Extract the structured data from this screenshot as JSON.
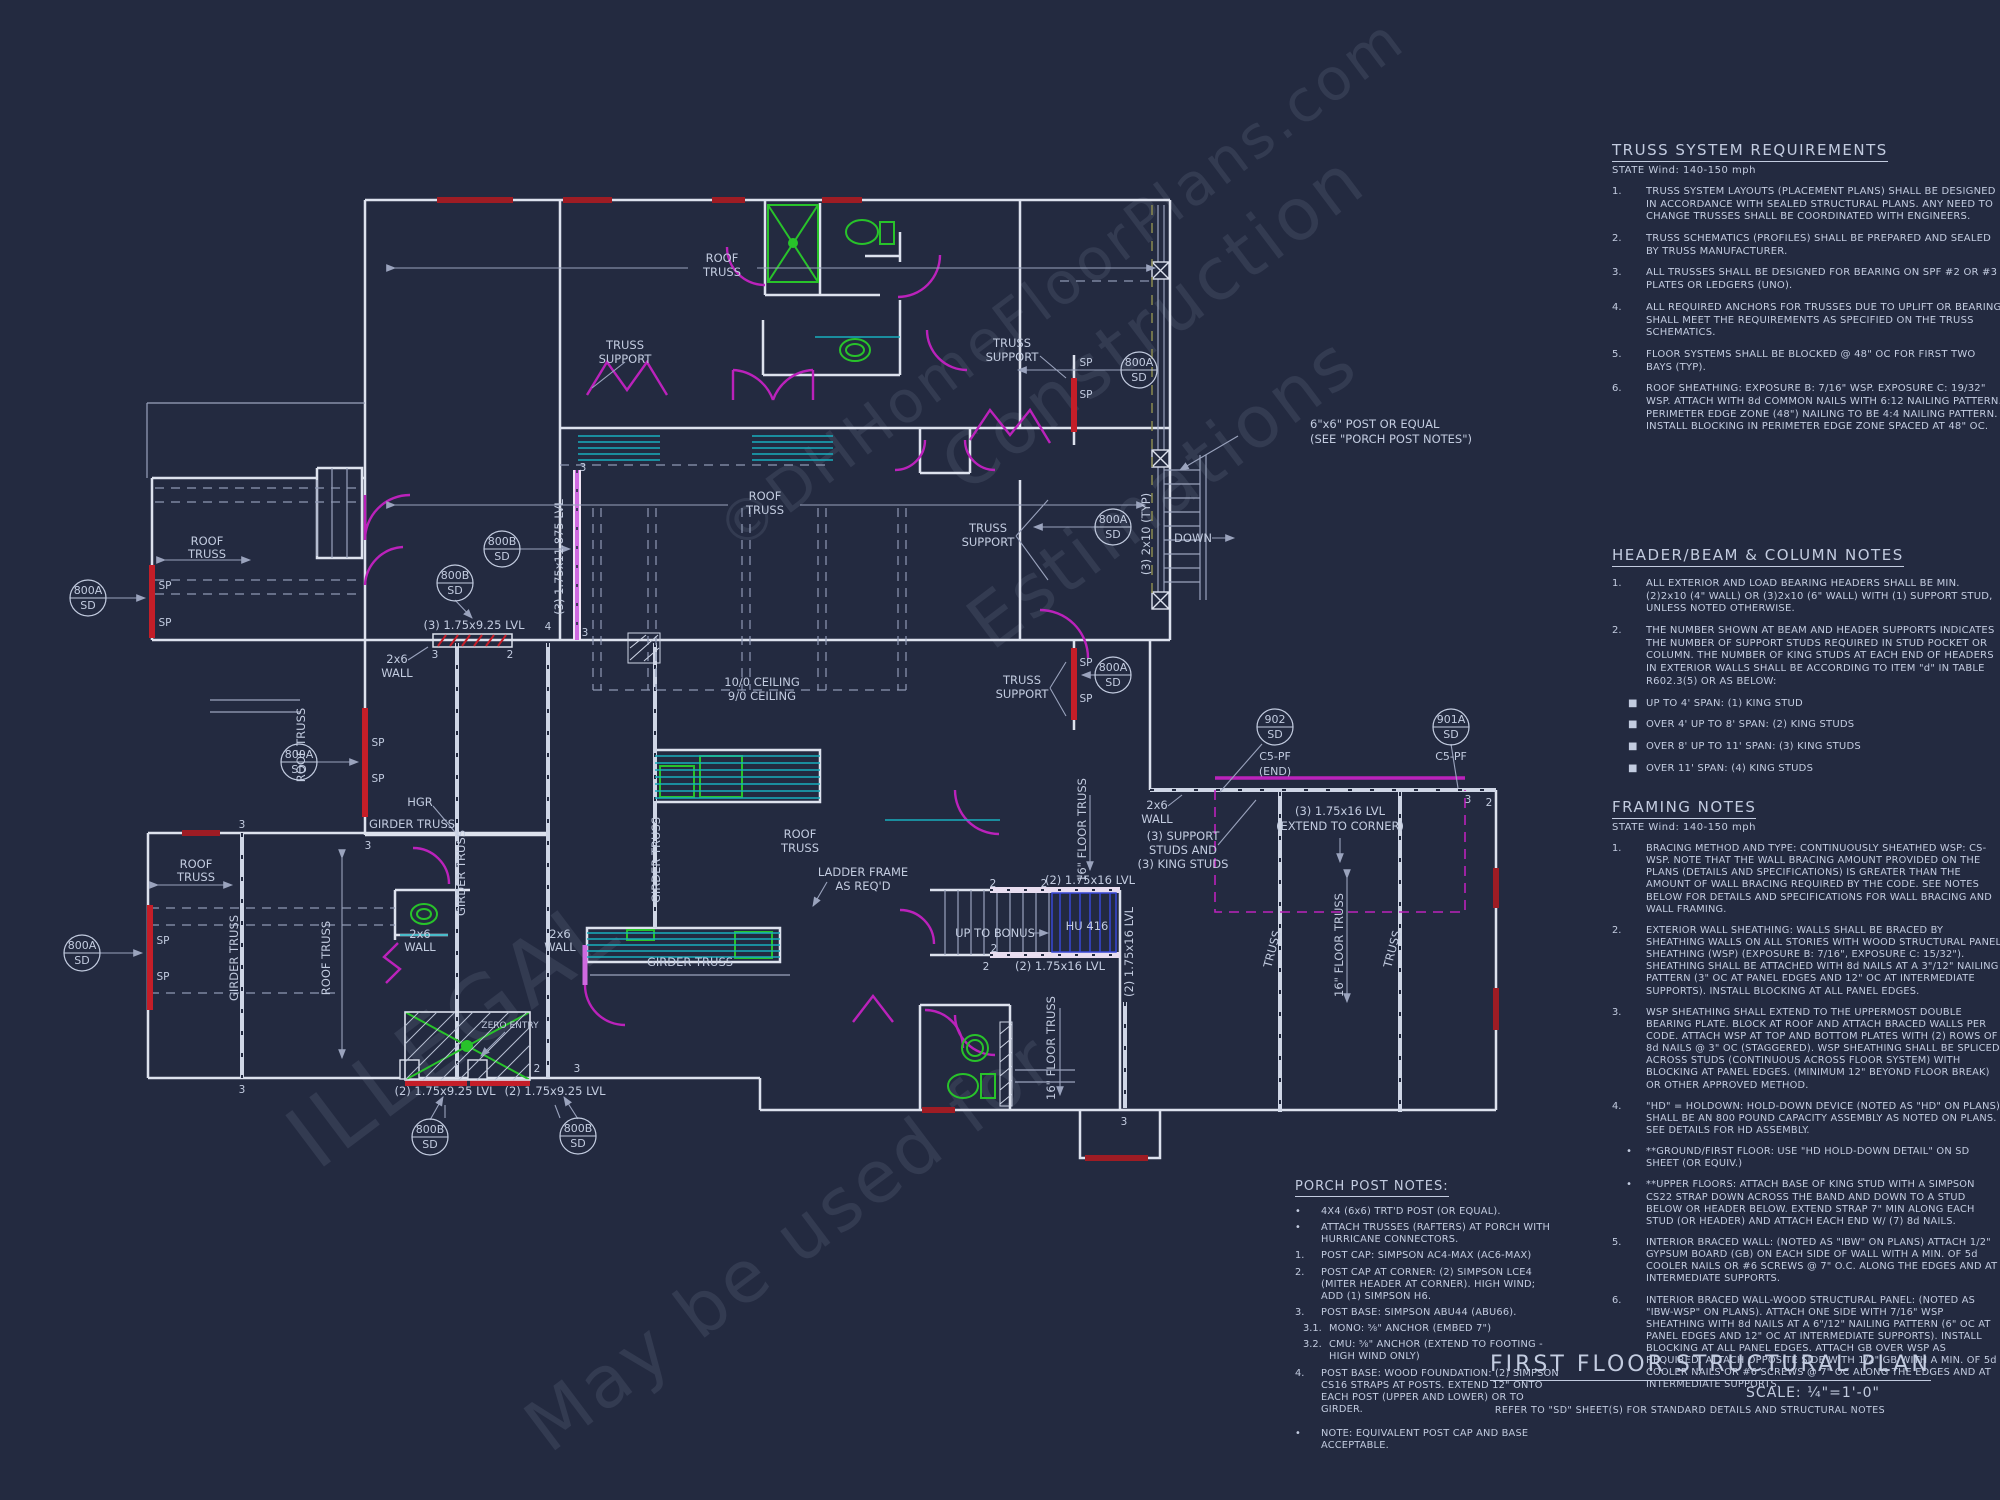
{
  "colors": {
    "background": "#232a40",
    "wall": "#dde2ee",
    "thin": "#9aa3bd",
    "dashed": "#8f99b4",
    "header_red": "#9e1c24",
    "sp_red": "#c41e28",
    "door_magenta": "#bb22bb",
    "beam_violet": "#cf6ae0",
    "fixture_green": "#28c32a",
    "counter_teal": "#18aebe",
    "stair_blue": "#3747d6",
    "text": "#c3cce0"
  },
  "truss_notes": {
    "title": "TRUSS SYSTEM REQUIREMENTS",
    "subtitle": "STATE Wind: 140-150 mph",
    "items": [
      {
        "num": "1.",
        "text": "TRUSS SYSTEM LAYOUTS (PLACEMENT PLANS)  SHALL BE DESIGNED IN ACCORDANCE WITH SEALED STRUCTURAL PLANS. ANY NEED TO CHANGE TRUSSES SHALL BE COORDINATED  WITH  ENGINEERS."
      },
      {
        "num": "2.",
        "text": "TRUSS SCHEMATICS (PROFILES) SHALL BE  PREPARED AND SEALED BY TRUSS  MANUFACTURER."
      },
      {
        "num": "3.",
        "text": "ALL TRUSSES SHALL BE DESIGNED FOR  BEARING ON SPF #2 OR #3 PLATES OR LEDGERS  (UNO)."
      },
      {
        "num": "4.",
        "text": "ALL REQUIRED ANCHORS FOR TRUSSES DUE  TO UPLIFT OR BEARING SHALL MEET THE  REQUIREMENTS AS SPECIFIED ON THE TRUSS  SCHEMATICS."
      },
      {
        "num": "5.",
        "text": "FLOOR SYSTEMS SHALL BE BLOCKED @ 48\" OC FOR FIRST TWO BAYS (TYP)."
      },
      {
        "num": "6.",
        "text": "ROOF SHEATHING: EXPOSURE B: 7/16\" WSP. EXPOSURE C: 19/32\" WSP. ATTACH WITH 8d COMMON NAILS WITH 6:12 NAILING PATTERN. PERIMETER EDGE ZONE (48\") NAILING TO BE 4:4 NAILING PATTERN. INSTALL BLOCKING IN PERIMETER EDGE ZONE SPACED AT 48\" OC."
      }
    ]
  },
  "header_notes": {
    "title": "HEADER/BEAM  &  COLUMN NOTES",
    "items": [
      {
        "num": "1.",
        "text": "ALL EXTERIOR AND LOAD BEARING HEADERS SHALL BE MIN. (2)2x10 (4\" WALL) OR (3)2x10 (6\" WALL) WITH (1) SUPPORT STUD, UNLESS NOTED OTHERWISE."
      },
      {
        "num": "2.",
        "text": "THE NUMBER SHOWN AT BEAM AND HEADER SUPPORTS INDICATES THE NUMBER OF SUPPORT STUDS REQUIRED IN STUD POCKET OR COLUMN. THE NUMBER OF KING STUDS AT EACH END OF HEADERS IN EXTERIOR WALLS SHALL BE ACCORDING TO ITEM \"d\" IN TABLE R602.3(5) OR AS BELOW:"
      }
    ],
    "bullets": [
      {
        "num": "■",
        "text": "UP TO 4' SPAN: (1) KING STUD"
      },
      {
        "num": "■",
        "text": "OVER 4' UP TO 8' SPAN: (2) KING STUDS"
      },
      {
        "num": "■",
        "text": "OVER 8' UP TO 11' SPAN: (3) KING STUDS"
      },
      {
        "num": "■",
        "text": "OVER 11' SPAN: (4) KING STUDS"
      }
    ]
  },
  "framing_notes": {
    "title": "FRAMING NOTES",
    "subtitle": "STATE Wind: 140-150 mph",
    "items": [
      {
        "num": "1.",
        "text": "BRACING METHOD AND TYPE: CONTINUOUSLY SHEATHED WSP: CS-WSP. NOTE THAT THE WALL BRACING AMOUNT PROVIDED ON THE PLANS (DETAILS AND SPECIFICATIONS) IS GREATER THAN THE AMOUNT OF WALL BRACING REQUIRED BY THE CODE. SEE NOTES BELOW FOR DETAILS AND SPECIFICATIONS FOR WALL BRACING AND WALL FRAMING."
      },
      {
        "num": "2.",
        "text": "EXTERIOR WALL SHEATHING: WALLS SHALL BE BRACED BY SHEATHING WALLS ON ALL STORIES WITH WOOD STRUCTURAL PANEL SHEATHING (WSP) (EXPOSURE B: 7/16\", EXPOSURE C: 15/32\"). SHEATHING SHALL BE ATTACHED WITH 8d NAILS AT A 3\"/12\" NAILING PATTERN (3\" OC AT PANEL EDGES AND 12\" OC AT INTERMEDIATE SUPPORTS). INSTALL BLOCKING AT ALL PANEL EDGES."
      },
      {
        "num": "3.",
        "text": "WSP SHEATHING SHALL EXTEND TO THE UPPERMOST DOUBLE BEARING PLATE. BLOCK AT ROOF AND ATTACH BRACED WALLS PER CODE. ATTACH WSP AT TOP AND BOTTOM PLATES WITH (2) ROWS OF 8d NAILS @ 3\" OC (STAGGERED).  WSP SHEATHING SHALL BE SPLICED ACROSS STUDS (CONTINUOUS ACROSS FLOOR SYSTEM) WITH BLOCKING AT PANEL EDGES. (MINIMUM 12\" BEYOND FLOOR BREAK) OR OTHER APPROVED METHOD."
      },
      {
        "num": "4.",
        "text": "\"HD\" = HOLDOWN: HOLD-DOWN DEVICE (NOTED AS \"HD\" ON PLANS) SHALL BE AN 800 POUND CAPACITY ASSEMBLY AS NOTED ON PLANS. SEE DETAILS FOR HD ASSEMBLY."
      },
      {
        "num": "5.",
        "text": "INTERIOR BRACED WALL: (NOTED AS \"IBW\" ON PLANS) ATTACH 1/2\" GYPSUM BOARD (GB) ON EACH SIDE OF WALL WITH A MIN. OF 5d COOLER NAILS OR #6 SCREWS @ 7\" O.C. ALONG THE EDGES AND AT INTERMEDIATE SUPPORTS."
      },
      {
        "num": "6.",
        "text": "INTERIOR BRACED WALL-WOOD STRUCTURAL PANEL: (NOTED AS \"IBW-WSP\" ON PLANS). ATTACH ONE SIDE WITH 7/16\" WSP SHEATHING WITH 8d NAILS AT A 6\"/12\" NAILING PATTERN (6\" OC AT PANEL EDGES AND 12\" OC AT INTERMEDIATE SUPPORTS). INSTALL BLOCKING AT ALL PANEL EDGES. ATTACH GB OVER WSP AS REQUIRED. ATTACH OPPOSITE SIDE WITH 1/2\" GB WITH A MIN. OF 5d COOLER NAILS OR #6 SCREWS @ 7\" OC ALONG THE EDGES AND AT INTERMEDIATE SUPPORTS."
      }
    ],
    "sub_bullets": [
      {
        "num": "•",
        "text": "**GROUND/FIRST FLOOR:  USE \"HD HOLD-DOWN DETAIL\" ON SD SHEET (OR EQUIV.)"
      },
      {
        "num": "•",
        "text": "**UPPER FLOORS: ATTACH BASE OF KING STUD WITH A SIMPSON CS22 STRAP DOWN ACROSS THE BAND AND DOWN TO A STUD BELOW OR HEADER BELOW.  EXTEND STRAP 7\" MIN ALONG EACH STUD (OR HEADER) AND ATTACH EACH END W/ (7) 8d NAILS."
      }
    ]
  },
  "porch_notes": {
    "title": "PORCH POST NOTES:",
    "items": [
      {
        "num": "•",
        "text": "4X4 (6x6) TRT'D POST (OR EQUAL)."
      },
      {
        "num": "•",
        "text": "ATTACH TRUSSES (RAFTERS) AT PORCH WITH HURRICANE CONNECTORS."
      },
      {
        "num": "1.",
        "text": "POST CAP: SIMPSON AC4-MAX (AC6-MAX)"
      },
      {
        "num": "2.",
        "text": "POST CAP AT CORNER: (2) SIMPSON LCE4 (MITER HEADER AT CORNER).  HIGH WIND; ADD (1) SIMPSON H6."
      },
      {
        "num": "3.",
        "text": "POST BASE: SIMPSON ABU44 (ABU66)."
      },
      {
        "num": "3.1.",
        "text": "MONO: ⅝\" ANCHOR (EMBED 7\")"
      },
      {
        "num": "3.2.",
        "text": "CMU: ⅝\" ANCHOR (EXTEND TO FOOTING - HIGH WIND ONLY)"
      },
      {
        "num": "4.",
        "text": "POST BASE: WOOD FOUNDATION: (2) SIMPSON CS16 STRAPS AT POSTS.  EXTEND 12\" ONTO EACH POST (UPPER AND LOWER) OR TO GIRDER."
      },
      {
        "num": "•",
        "text": "NOTE: EQUIVALENT POST CAP AND BASE ACCEPTABLE."
      }
    ]
  },
  "titleblock": {
    "title": "FIRST FLOOR STRUCTURAL PLAN",
    "scale": "SCALE: ¼\"=1'-0\"",
    "refer": "REFER TO \"SD\" SHEET(S) FOR STANDARD DETAILS AND STRUCTURAL NOTES"
  },
  "watermarks": {
    "w1": "©DHHomeFloorPlans.com",
    "w2": "Construction",
    "w3": "Estimations",
    "w4": "ILLEGAL",
    "w5": "May be used for"
  },
  "plan_labels": {
    "roof": "ROOF",
    "truss": "TRUSS",
    "support": "SUPPORT",
    "roof_truss": "ROOF TRUSS",
    "girder_truss": "GIRDER TRUSS",
    "sp": "SP",
    "down": "DOWN",
    "hgr": "HGR",
    "hu416": "HU 416",
    "up_to_bonus": "UP TO BONUS",
    "zero_entry": "ZERO ENTRY",
    "ladder1": "LADDER FRAME",
    "ladder2": "AS REQ'D",
    "ceil1": "10/0 CEILING",
    "ceil2": "9/0 CEILING",
    "w2x6_1": "2x6",
    "w2x6_2": "WALL",
    "lvl_3_925": "(3) 1.75x9.25 LVL",
    "lvl_2_925": "(2) 1.75x9.25 LVL",
    "lvl_3_11875": "(3) 1.75x11.875 LVL",
    "lvl_2_16": "(2) 1.75x16 LVL",
    "lvl_3_16": "(3) 1.75x16 LVL",
    "ext_corner": "(EXTEND TO CORNER)",
    "p2x10": "(3) 2x10 (TYP)",
    "post1": "6\"x6\" POST OR EQUAL",
    "post2": "(SEE \"PORCH POST NOTES\")",
    "studs1": "(3) SUPPORT",
    "studs2": "STUDS AND",
    "studs3": "(3) KING STUDS",
    "ft16": "16\" FLOOR TRUSS",
    "c5pf": "C5-PF",
    "end": "(END)",
    "sd": "SD",
    "d800a": "800A",
    "d800b": "800B",
    "d902": "902",
    "d901a": "901A",
    "n2": "2",
    "n3": "3",
    "n4": "4"
  }
}
